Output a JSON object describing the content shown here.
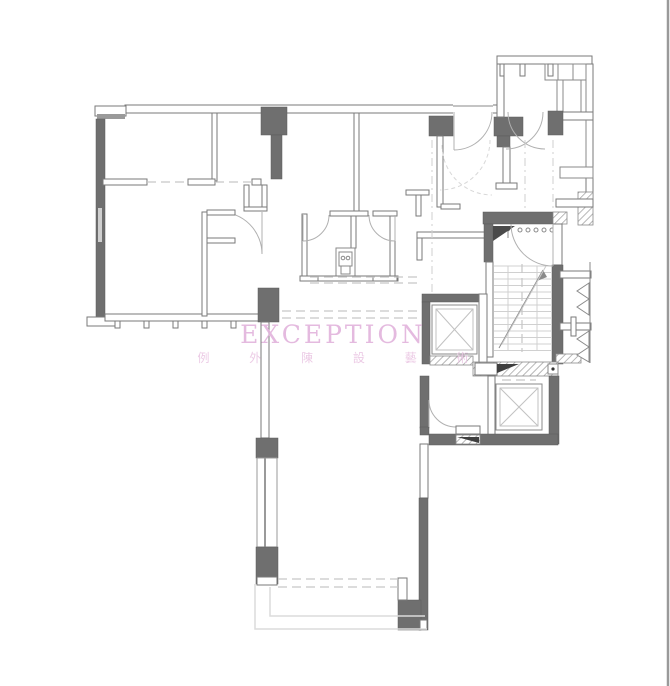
{
  "watermark": {
    "title": "EXCEPTION",
    "subtitle": "例 外 陳 設 藝 術"
  },
  "colors": {
    "background": "#ffffff",
    "wall_fill": "#6f6f6f",
    "wall_line": "#7a7a7a",
    "light_line": "#c9c9c9",
    "dashed_line": "#c6c6c6",
    "watermark_title": "#e2b3dc",
    "watermark_subtitle": "#eac6e3",
    "border_line": "#9a9a9a"
  },
  "plan_features": [
    "exterior walls with gray poché columns",
    "interior partitions with door swing arcs",
    "window wall with mullion ticks",
    "central bathroom fixture",
    "kitchen cabinetry block (top right)",
    "stair run with tread lines and arrows",
    "two elevator shafts with X diagonals",
    "entry corridor with hatched walls",
    "terrace with dashed edge lines (bottom)"
  ]
}
